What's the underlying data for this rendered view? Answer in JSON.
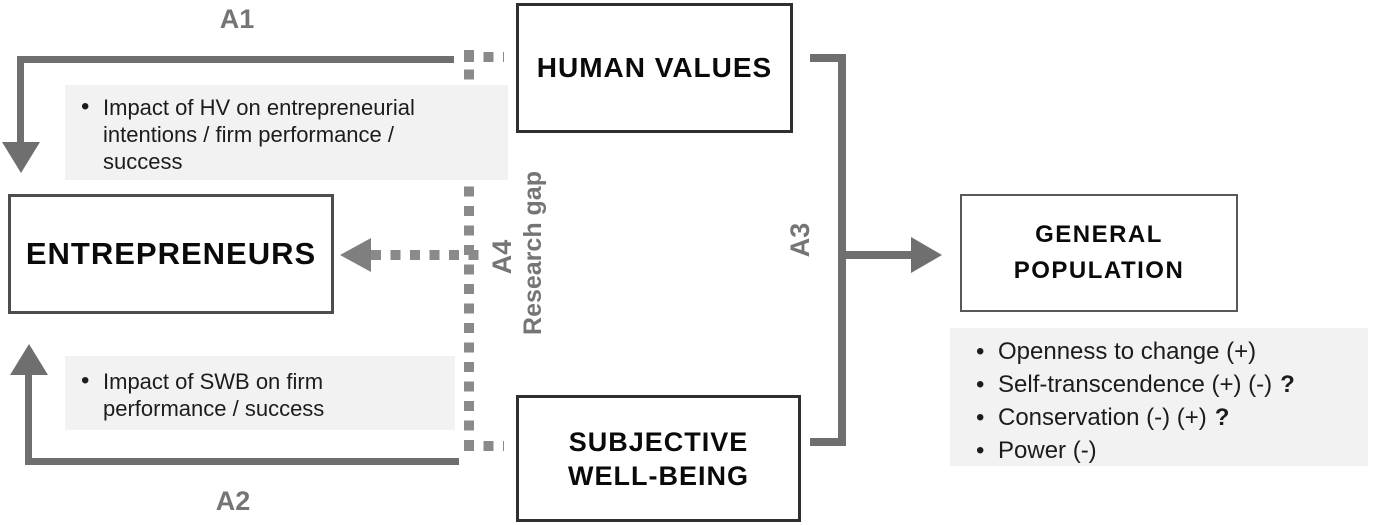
{
  "diagram": {
    "boxes": {
      "human_values": {
        "label": "HUMAN VALUES"
      },
      "entrepreneurs": {
        "label": "ENTREPRENEURS"
      },
      "subjective_well_being": {
        "lines": [
          "SUBJECTIVE",
          "WELL-BEING"
        ]
      },
      "general_population": {
        "lines": [
          "GENERAL",
          "POPULATION"
        ]
      }
    },
    "arrow_labels": {
      "a1": "A1",
      "a2": "A2",
      "a3": "A3",
      "a4": "A4",
      "research_gap": "Research gap"
    },
    "panels": {
      "hv_impact": {
        "lines": [
          "Impact of HV on entrepreneurial",
          "intentions / firm performance /",
          "success"
        ]
      },
      "swb_impact": {
        "lines": [
          "Impact of SWB on firm",
          "performance / success"
        ]
      },
      "gp_values": {
        "items": [
          {
            "text": "Openness to change (+)",
            "q": ""
          },
          {
            "text": "Self-transcendence (+) (-)",
            "q": "?"
          },
          {
            "text": "Conservation (-) (+)",
            "q": "?"
          },
          {
            "text": "Power (-)",
            "q": ""
          }
        ]
      }
    },
    "glyphs": {
      "bullet": "•"
    },
    "colors": {
      "arrow_gray": "#6f6f6f",
      "dotted_gray": "#8a8a8a",
      "dashed_arrowhead_gray": "#7f7f7f",
      "label_gray": "#757575",
      "panel_bg": "#f2f2f2",
      "box_border_dark": "#2f2f2f",
      "box_border_mid": "#57585a",
      "text_black": "#0a0a0a",
      "background": "#ffffff"
    }
  }
}
